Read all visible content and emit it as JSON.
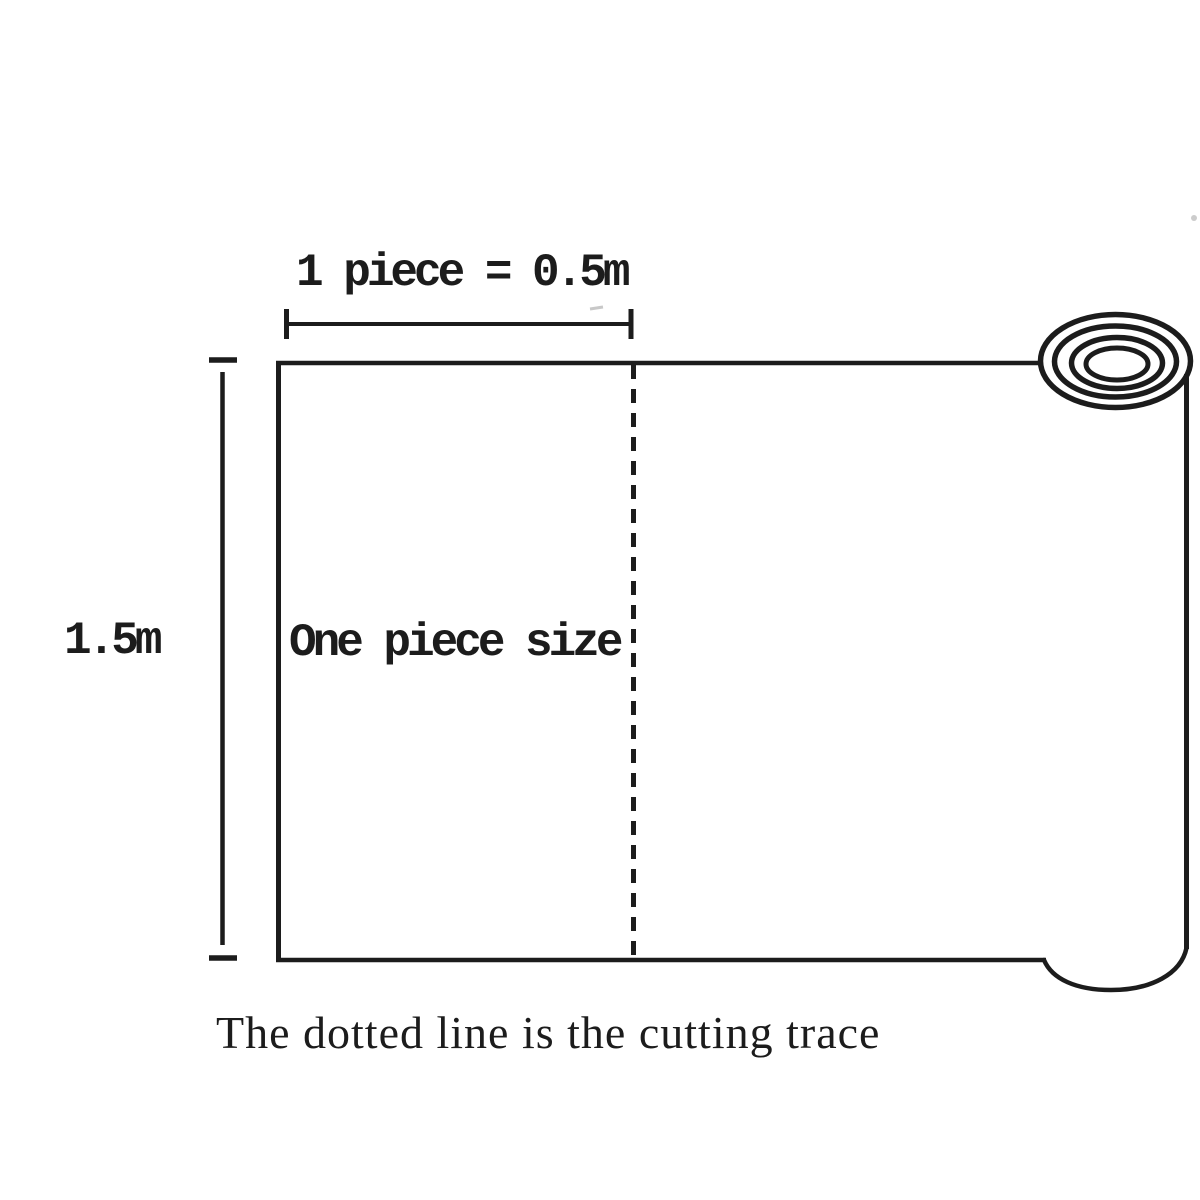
{
  "labels": {
    "piece_width": "1 piece = 0.5m",
    "roll_height": "1.5m",
    "piece_area": "One piece size",
    "caption": "The dotted line is the cutting trace"
  },
  "icons": {
    "roll_end": "rolled-material-end-rings",
    "cutting_line": "dashed-cutting-trace-line"
  },
  "colors": {
    "ink": "#1c1c1c",
    "background": "#ffffff",
    "faint": "#9a9a9a"
  }
}
